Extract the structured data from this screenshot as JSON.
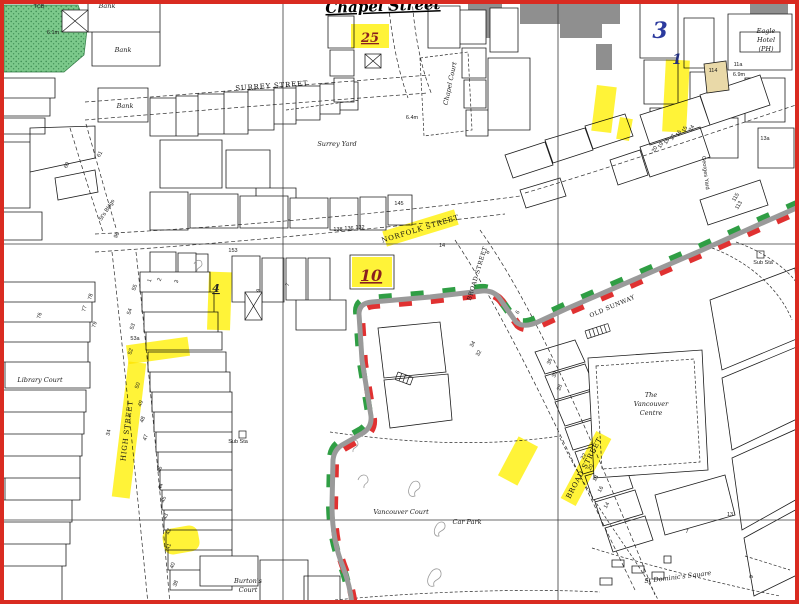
{
  "map": {
    "title": "Chapel Street",
    "colors": {
      "border_red": "#d92b21",
      "highlight": "#ffef00",
      "route_green": "#2f9e44",
      "route_red": "#e03131",
      "route_grey": "#9a9a9a",
      "grey_building": "#8f8f8f",
      "tan_building": "#e9d9a8",
      "woodland": "#7cc98b",
      "annotation_red": "#8a1f1f",
      "annotation_blue": "#2b3a9e"
    },
    "labels": [
      {
        "t": "Chapel Street",
        "x": 383,
        "y": 11,
        "r": -2,
        "c": "title"
      },
      {
        "t": "25",
        "x": 370,
        "y": 42,
        "c": "mk-red"
      },
      {
        "t": "10",
        "x": 371,
        "y": 281,
        "c": "mk-red2"
      },
      {
        "t": "3",
        "x": 660,
        "y": 38,
        "c": "mk-blue"
      },
      {
        "t": "1",
        "x": 677,
        "y": 64,
        "c": "mk-blue2"
      },
      {
        "t": "4",
        "x": 216,
        "y": 292,
        "c": "mk-ink"
      },
      {
        "t": "SURREY STREET",
        "x": 272,
        "y": 88,
        "r": -4,
        "c": "street"
      },
      {
        "t": "NORFOLK STREET",
        "x": 421,
        "y": 231,
        "r": -17,
        "c": "street"
      },
      {
        "t": "BROAD STREET",
        "x": 479,
        "y": 274,
        "r": -73,
        "c": "street-sm"
      },
      {
        "t": "BROAD STREET",
        "x": 586,
        "y": 469,
        "r": -62,
        "c": "street"
      },
      {
        "t": "OLD SUNWAY",
        "x": 613,
        "y": 308,
        "r": -23,
        "c": "street-sm"
      },
      {
        "t": "HIGH STREET",
        "x": 129,
        "y": 431,
        "r": -83,
        "c": "street"
      },
      {
        "t": "Surrey Yard",
        "x": 337,
        "y": 146,
        "c": "name"
      },
      {
        "t": "Library Court",
        "x": 40,
        "y": 382,
        "c": "name"
      },
      {
        "t": "Chapel Court",
        "x": 452,
        "y": 84,
        "r": -78,
        "c": "name"
      },
      {
        "t": "Eagle",
        "x": 766,
        "y": 33,
        "c": "name"
      },
      {
        "t": "Hotel",
        "x": 766,
        "y": 42,
        "c": "name"
      },
      {
        "t": "(PH)",
        "x": 766,
        "y": 51,
        "c": "name"
      },
      {
        "t": "Bank",
        "x": 107,
        "y": 8,
        "c": "name"
      },
      {
        "t": "Bank",
        "x": 123,
        "y": 52,
        "c": "name"
      },
      {
        "t": "Bank",
        "x": 125,
        "y": 108,
        "c": "name"
      },
      {
        "t": "The",
        "x": 651,
        "y": 397,
        "c": "name"
      },
      {
        "t": "Vancouver",
        "x": 651,
        "y": 406,
        "c": "name"
      },
      {
        "t": "Centre",
        "x": 651,
        "y": 415,
        "c": "name"
      },
      {
        "t": "Vancouver Court",
        "x": 401,
        "y": 514,
        "c": "name"
      },
      {
        "t": "Car Park",
        "x": 467,
        "y": 524,
        "c": "name"
      },
      {
        "t": "St Dominic's Square",
        "x": 678,
        "y": 579,
        "r": -7,
        "c": "name"
      },
      {
        "t": "Burton's",
        "x": 248,
        "y": 583,
        "c": "name"
      },
      {
        "t": "Court",
        "x": 248,
        "y": 592,
        "c": "name"
      },
      {
        "t": "Georges Yard",
        "x": 704,
        "y": 173,
        "r": 83,
        "c": "tiny"
      },
      {
        "t": "St's Bldgs",
        "x": 108,
        "y": 211,
        "r": -57,
        "c": "tiny"
      },
      {
        "t": "Sub Sta",
        "x": 763,
        "y": 264,
        "c": "tiny"
      },
      {
        "t": "Sub Sta",
        "x": 238,
        "y": 443,
        "c": "tiny"
      },
      {
        "t": "TCB",
        "x": 39,
        "y": 8,
        "c": "tiny"
      },
      {
        "t": "6.1m",
        "x": 53,
        "y": 34,
        "c": "tiny"
      },
      {
        "t": "6.4m",
        "x": 412,
        "y": 119,
        "c": "tiny"
      },
      {
        "t": "6.9m",
        "x": 739,
        "y": 76,
        "c": "tiny"
      },
      {
        "t": "114",
        "x": 713,
        "y": 72,
        "c": "tiny"
      },
      {
        "t": "11a",
        "x": 738,
        "y": 66,
        "c": "tiny"
      },
      {
        "t": "153",
        "x": 233,
        "y": 252,
        "c": "tiny"
      },
      {
        "t": "138",
        "x": 338,
        "y": 231,
        "c": "tiny"
      },
      {
        "t": "136",
        "x": 349,
        "y": 230,
        "c": "tiny"
      },
      {
        "t": "132",
        "x": 360,
        "y": 229,
        "c": "tiny"
      },
      {
        "t": "145",
        "x": 399,
        "y": 205,
        "c": "tiny"
      },
      {
        "t": "14",
        "x": 442,
        "y": 247,
        "c": "tiny"
      },
      {
        "t": "8",
        "x": 489,
        "y": 253,
        "r": -60,
        "c": "tiny"
      },
      {
        "t": "6",
        "x": 519,
        "y": 313,
        "r": -60,
        "c": "tiny"
      },
      {
        "t": "34",
        "x": 474,
        "y": 345,
        "r": -60,
        "c": "tiny"
      },
      {
        "t": "32",
        "x": 480,
        "y": 354,
        "r": -60,
        "c": "tiny"
      },
      {
        "t": "24",
        "x": 693,
        "y": 129,
        "r": -60,
        "c": "tiny"
      },
      {
        "t": "20",
        "x": 656,
        "y": 150,
        "r": -60,
        "c": "tiny"
      },
      {
        "t": "19",
        "x": 662,
        "y": 146,
        "r": -60,
        "c": "tiny"
      },
      {
        "t": "18",
        "x": 668,
        "y": 142,
        "r": -60,
        "c": "tiny"
      },
      {
        "t": "17",
        "x": 674,
        "y": 138,
        "r": -60,
        "c": "tiny"
      },
      {
        "t": "16",
        "x": 680,
        "y": 134,
        "r": -60,
        "c": "tiny"
      },
      {
        "t": "15",
        "x": 686,
        "y": 130,
        "r": -60,
        "c": "tiny"
      },
      {
        "t": "13a",
        "x": 765,
        "y": 140,
        "c": "tiny"
      },
      {
        "t": "115",
        "x": 737,
        "y": 198,
        "r": -60,
        "c": "tiny"
      },
      {
        "t": "113",
        "x": 740,
        "y": 206,
        "r": -60,
        "c": "tiny"
      },
      {
        "t": "36",
        "x": 551,
        "y": 362,
        "r": -70,
        "c": "tiny"
      },
      {
        "t": "30",
        "x": 556,
        "y": 375,
        "r": -70,
        "c": "tiny"
      },
      {
        "t": "28",
        "x": 561,
        "y": 388,
        "r": -70,
        "c": "tiny"
      },
      {
        "t": "22",
        "x": 585,
        "y": 457,
        "r": -62,
        "c": "tiny"
      },
      {
        "t": "20",
        "x": 592,
        "y": 468,
        "r": -62,
        "c": "tiny"
      },
      {
        "t": "18",
        "x": 597,
        "y": 479,
        "r": -62,
        "c": "tiny"
      },
      {
        "t": "16",
        "x": 602,
        "y": 490,
        "r": -62,
        "c": "tiny"
      },
      {
        "t": "14",
        "x": 608,
        "y": 506,
        "r": -62,
        "c": "tiny"
      },
      {
        "t": "7",
        "x": 687,
        "y": 533,
        "c": "tiny"
      },
      {
        "t": "13",
        "x": 730,
        "y": 516,
        "c": "tiny"
      },
      {
        "t": "9",
        "x": 753,
        "y": 577,
        "r": -80,
        "c": "tiny"
      },
      {
        "t": "55",
        "x": 136,
        "y": 288,
        "r": -70,
        "c": "tiny"
      },
      {
        "t": "54",
        "x": 131,
        "y": 312,
        "r": -70,
        "c": "tiny"
      },
      {
        "t": "53",
        "x": 134,
        "y": 327,
        "r": -70,
        "c": "tiny"
      },
      {
        "t": "53a",
        "x": 135,
        "y": 340,
        "c": "tiny"
      },
      {
        "t": "52",
        "x": 132,
        "y": 352,
        "r": -70,
        "c": "tiny"
      },
      {
        "t": "50",
        "x": 139,
        "y": 386,
        "r": -70,
        "c": "tiny"
      },
      {
        "t": "49",
        "x": 142,
        "y": 404,
        "r": -70,
        "c": "tiny"
      },
      {
        "t": "48",
        "x": 144,
        "y": 420,
        "r": -70,
        "c": "tiny"
      },
      {
        "t": "47",
        "x": 147,
        "y": 438,
        "r": -70,
        "c": "tiny"
      },
      {
        "t": "34",
        "x": 110,
        "y": 433,
        "r": -75,
        "c": "tiny"
      },
      {
        "t": "46",
        "x": 161,
        "y": 470,
        "r": -70,
        "c": "tiny"
      },
      {
        "t": "44",
        "x": 162,
        "y": 487,
        "r": -70,
        "c": "tiny"
      },
      {
        "t": "45",
        "x": 165,
        "y": 500,
        "r": -70,
        "c": "tiny"
      },
      {
        "t": "43",
        "x": 167,
        "y": 517,
        "r": -70,
        "c": "tiny"
      },
      {
        "t": "42",
        "x": 170,
        "y": 532,
        "r": -70,
        "c": "tiny"
      },
      {
        "t": "41",
        "x": 170,
        "y": 547,
        "r": -70,
        "c": "tiny"
      },
      {
        "t": "40",
        "x": 174,
        "y": 566,
        "r": -70,
        "c": "tiny"
      },
      {
        "t": "38",
        "x": 177,
        "y": 584,
        "r": -70,
        "c": "tiny"
      },
      {
        "t": "76",
        "x": 41,
        "y": 316,
        "r": -75,
        "c": "tiny"
      },
      {
        "t": "77",
        "x": 86,
        "y": 309,
        "r": -75,
        "c": "tiny"
      },
      {
        "t": "78",
        "x": 92,
        "y": 297,
        "r": -75,
        "c": "tiny"
      },
      {
        "t": "79",
        "x": 96,
        "y": 325,
        "r": -75,
        "c": "tiny"
      },
      {
        "t": "61",
        "x": 101,
        "y": 155,
        "r": -60,
        "c": "tiny"
      },
      {
        "t": "60",
        "x": 68,
        "y": 166,
        "r": -60,
        "c": "tiny"
      },
      {
        "t": "96",
        "x": 118,
        "y": 236,
        "r": -60,
        "c": "tiny"
      },
      {
        "t": "1",
        "x": 151,
        "y": 281,
        "r": -70,
        "c": "tiny"
      },
      {
        "t": "2",
        "x": 161,
        "y": 280,
        "r": -70,
        "c": "tiny"
      },
      {
        "t": "3",
        "x": 178,
        "y": 282,
        "r": -70,
        "c": "tiny"
      },
      {
        "t": "9",
        "x": 260,
        "y": 291,
        "r": -70,
        "c": "tiny"
      },
      {
        "t": "7",
        "x": 289,
        "y": 285,
        "r": -70,
        "c": "tiny"
      }
    ],
    "highlights": [
      {
        "x": 351,
        "y": 24,
        "w": 38,
        "h": 24,
        "r": 0
      },
      {
        "x": 594,
        "y": 86,
        "w": 20,
        "h": 46,
        "r": 7
      },
      {
        "x": 664,
        "y": 60,
        "w": 24,
        "h": 72,
        "r": 3
      },
      {
        "x": 618,
        "y": 118,
        "w": 13,
        "h": 22,
        "r": 10
      },
      {
        "x": 352,
        "y": 257,
        "w": 40,
        "h": 30,
        "r": 0
      },
      {
        "x": 208,
        "y": 272,
        "w": 23,
        "h": 58,
        "r": 2
      },
      {
        "x": 127,
        "y": 341,
        "w": 62,
        "h": 19,
        "r": -8
      },
      {
        "x": 383,
        "y": 220,
        "w": 75,
        "h": 16,
        "r": -17
      },
      {
        "x": 61,
        "y": 421,
        "w": 136,
        "h": 18,
        "r": -83
      },
      {
        "x": 548,
        "y": 460,
        "w": 76,
        "h": 17,
        "r": -62
      },
      {
        "x": 496,
        "y": 450,
        "w": 44,
        "h": 22,
        "r": -62
      },
      {
        "x": 163,
        "y": 527,
        "w": 36,
        "h": 26,
        "r": -10,
        "rx": 9
      }
    ]
  }
}
